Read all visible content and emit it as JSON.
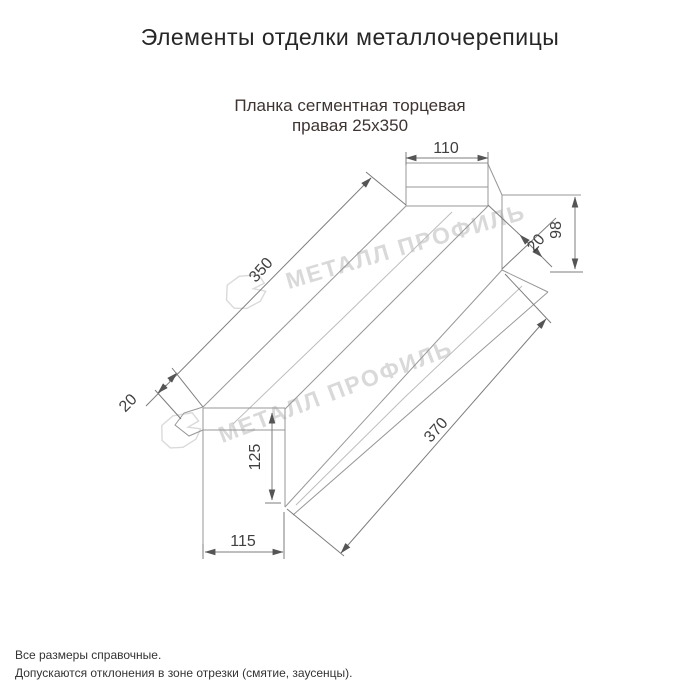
{
  "page": {
    "title": "Элементы отделки металлочерепицы",
    "subtitle_line1": "Планка сегментная торцевая",
    "subtitle_line2": "правая 25х350",
    "footer_line1": "Все размеры справочные.",
    "footer_line2": "Допускаются отклонения в зоне отрезки (смятие, заусенцы)."
  },
  "drawing": {
    "dimensions": {
      "top_width": "110",
      "right_height": "98",
      "right_hem": "20",
      "face_length": "350",
      "left_hem": "20",
      "bottom_height": "125",
      "bottom_width": "115",
      "base_length": "370"
    },
    "watermark": {
      "text": "МЕТАЛЛ ПРОФИЛЬ",
      "logo": "compass-star-icon"
    },
    "colors": {
      "line": "#979797",
      "dim_text": "#404040",
      "watermark": "#d9d9d9",
      "title": "#262626",
      "subtitle": "#3e3432"
    }
  }
}
